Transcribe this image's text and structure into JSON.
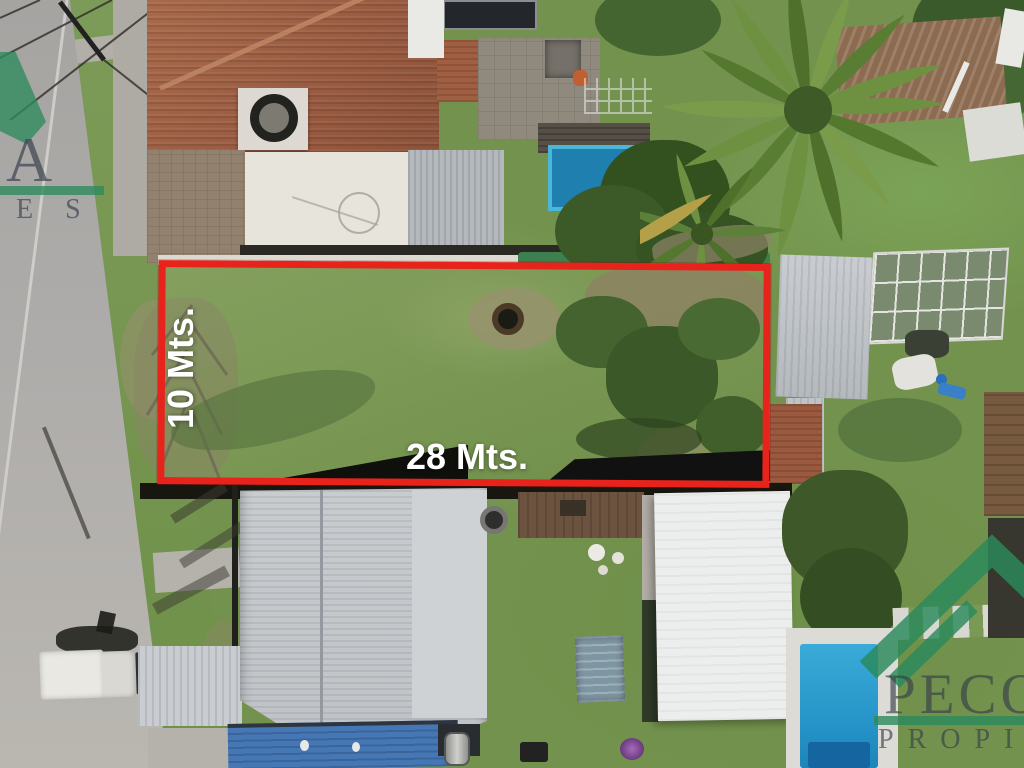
{
  "meta": {
    "type": "aerial-drone-photo",
    "subject": "Residential land lot for sale, outlined in red, suburban block with houses, pools and gardens"
  },
  "annotations": {
    "depth_label": "10 Mts.",
    "width_label": "28 Mts.",
    "outline_color": "#e8231c",
    "label_color": "#ffffff"
  },
  "watermarks": {
    "green": "#2e8a5c",
    "text_color": "#3a4148",
    "top_left": {
      "name_fragment": "A",
      "subtitle_fragment": "ES"
    },
    "bottom_right": {
      "name_fragment": "PECO",
      "subtitle_fragment": "PROPIE"
    }
  },
  "scene_palette": {
    "road": "#aeacaa",
    "grass": "#73924e",
    "terracotta_roof": "#995b40",
    "gray_metal_roof": "#c5c9cd",
    "white_roof": "#eceeed",
    "blue_roof": "#4577b5",
    "pool_blue": "#2492c6"
  }
}
